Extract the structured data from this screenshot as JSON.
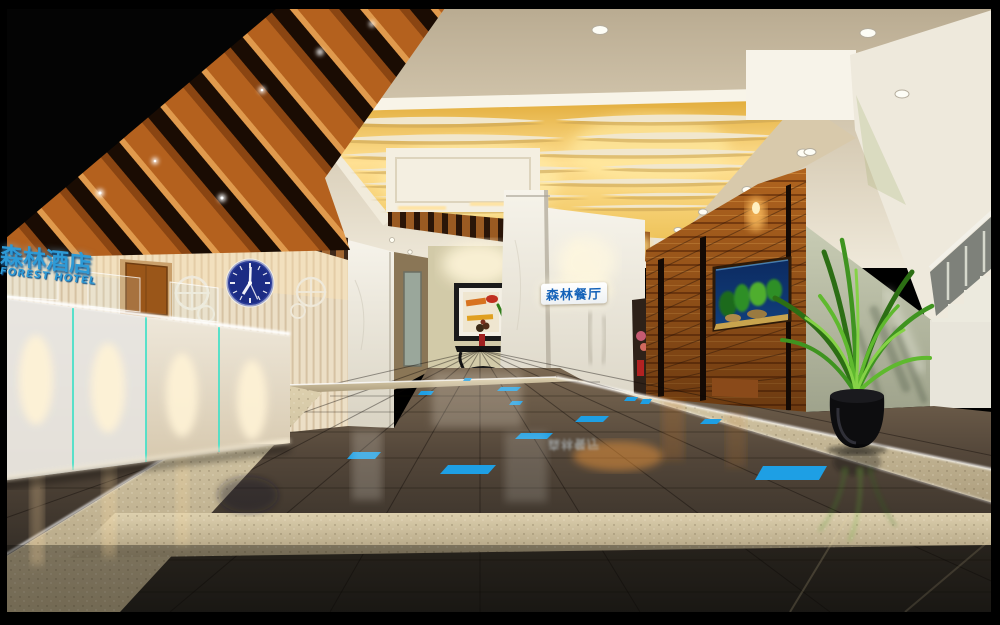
{
  "signs": {
    "hotel_cn": "森林酒店",
    "hotel_en": "FOREST HOTEL",
    "restaurant_cn": "森林餐厅",
    "restaurant_reflection": "森林餐厅"
  },
  "clock": {
    "hour_hand_transform": "rotate(212 250 283)",
    "minute_hand_transform": "rotate(2 250 283)",
    "second_hand_transform": "rotate(155 250 283)"
  },
  "colors": {
    "frame_black": "#000000",
    "wood_beam": "#b4611e",
    "wood_wall": "#a85c1d",
    "ceiling_cove_gold": "#ffdf8e",
    "hotel_sign_blue": "#2e9ad6",
    "restaurant_sign_blue": "#1462b8",
    "clock_face_navy": "#1c2c84",
    "accent_tile_blue": "#1e9fe4",
    "granite_walkway": "#cfc0a0",
    "floor_tile_brown": "#4a3f33",
    "sage_wall_green": "#b9bda6",
    "palm_green": "#47a12c",
    "marble_white": "#efece4"
  }
}
